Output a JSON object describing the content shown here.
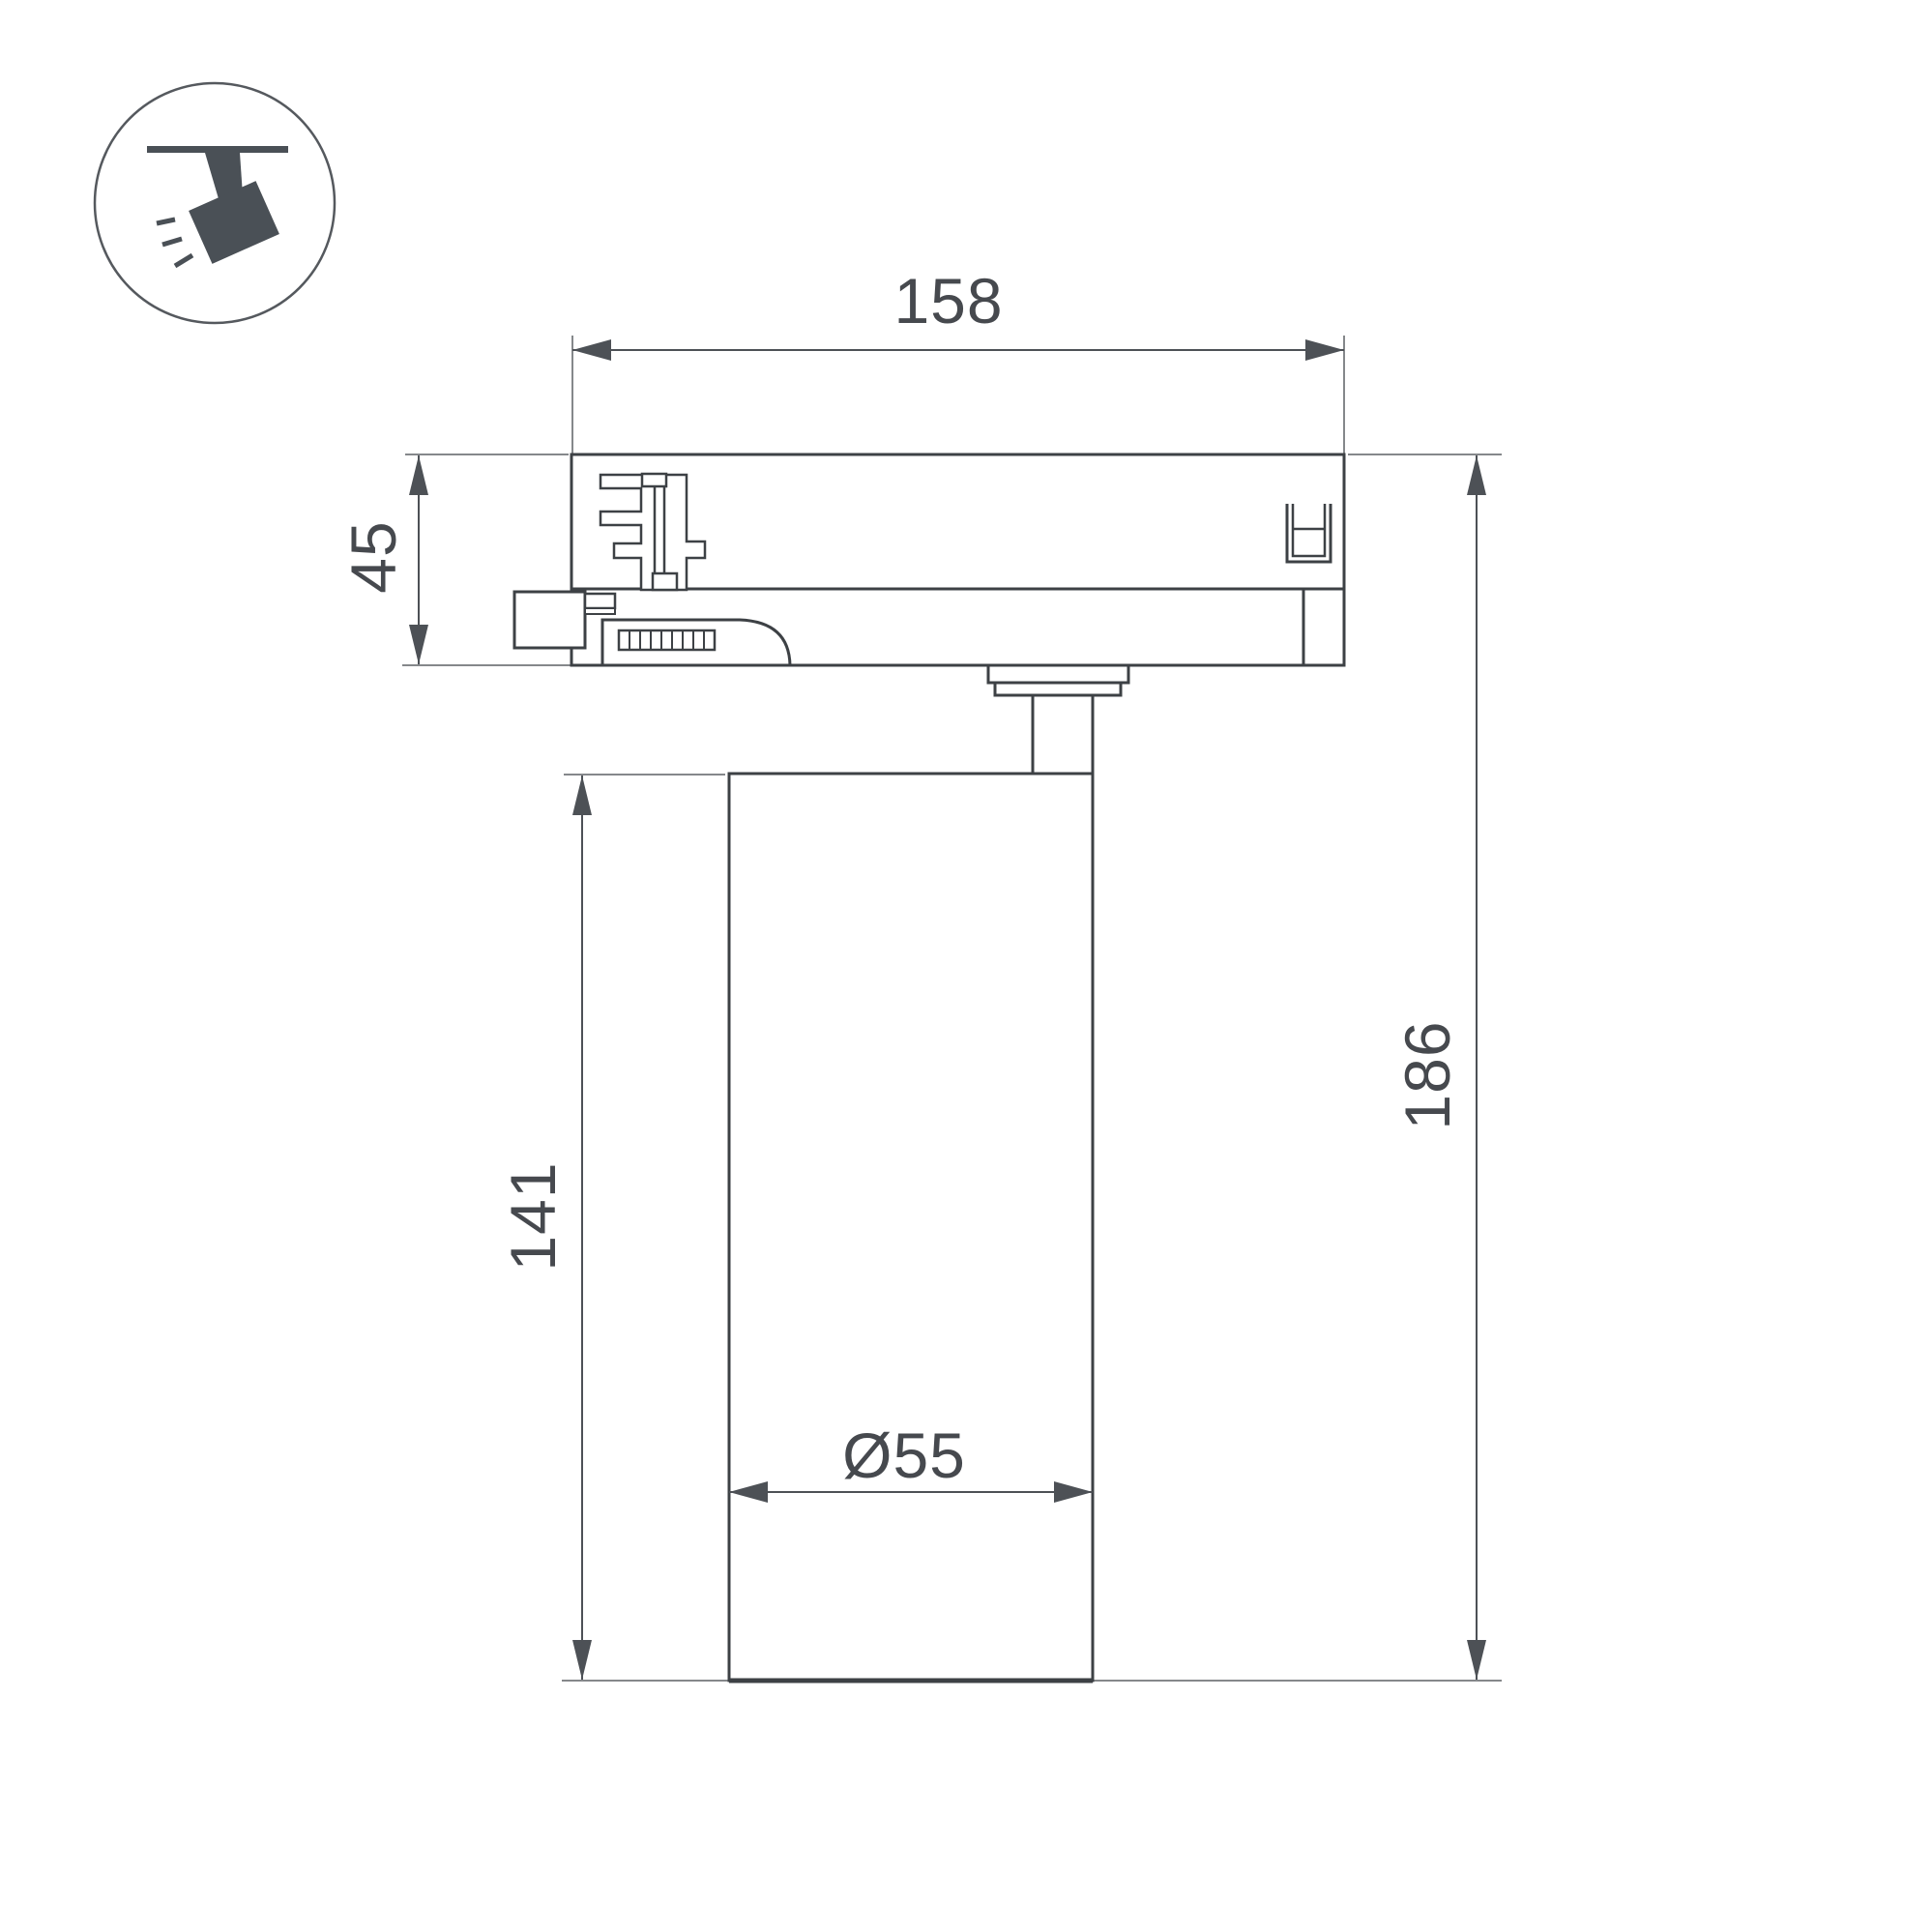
{
  "page": {
    "background": "#ffffff"
  },
  "icon": {
    "name": "ceiling-track-spotlight",
    "shape_color": "#4a5056",
    "circle_color": "#55595e"
  },
  "drawing": {
    "outline_color": "#3d4145",
    "dimension_color": "#4d5156",
    "extension_color": "#85888b",
    "text_color": "#46494e",
    "dimensions": {
      "track_width": "158",
      "adapter_height": "45",
      "body_height": "141",
      "total_height": "186",
      "body_diameter": "Ø55"
    }
  }
}
